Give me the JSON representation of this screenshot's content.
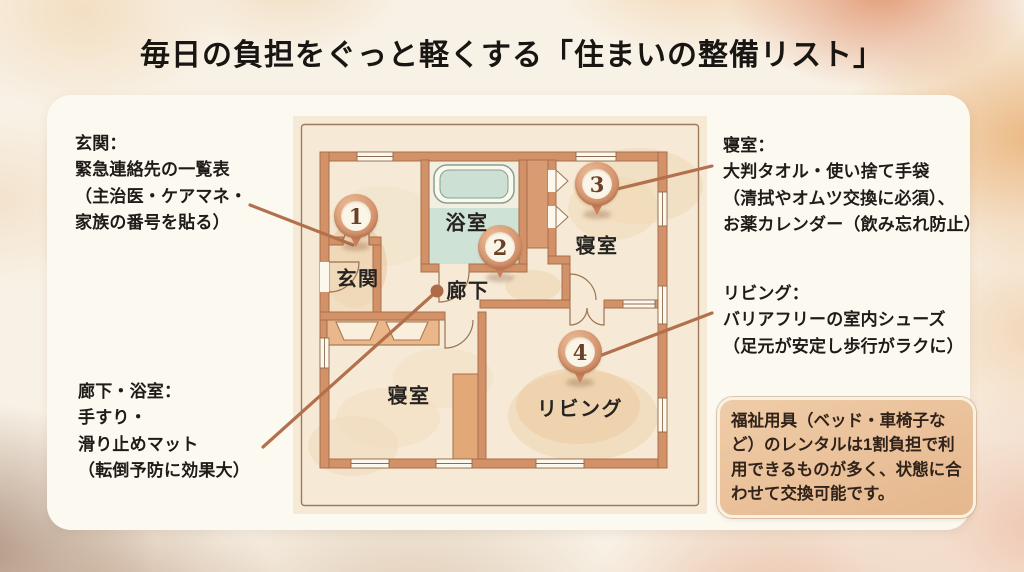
{
  "title": "毎日の負担をぐっと軽くする「住まいの整備リスト」",
  "notes": {
    "entrance": "玄関：\n緊急連絡先の一覧表\n（主治医・ケアマネ・\n家族の番号を貼る）",
    "bedroom": "寝室：\n大判タオル・使い捨て手袋\n（清拭やオムツ交換に必須）、\nお薬カレンダー（飲み忘れ防止）",
    "living": "リビング：\nバリアフリーの室内シューズ\n（足元が安定し歩行がラクに）",
    "hallway_bath": "廊下・浴室：\n手すり・\n滑り止めマット\n（転倒予防に効果大）"
  },
  "info_box": {
    "text": "福祉用具（ベッド・車椅子など）のレンタルは1割負担で利用できるものが多く、状態に合わせて交換可能です。"
  },
  "floor_plan": {
    "rooms": {
      "genkan": "玄関",
      "bath": "浴室",
      "hallway": "廊下",
      "bedroom_ne": "寝室",
      "bedroom_sw": "寝室",
      "living": "リビング"
    },
    "pins": [
      {
        "number": "1",
        "area": "genkan"
      },
      {
        "number": "2",
        "area": "hallway"
      },
      {
        "number": "3",
        "area": "bedroom_ne"
      },
      {
        "number": "4",
        "area": "living"
      }
    ]
  },
  "colors": {
    "wall": "#d39168",
    "connector_line": "#b2704c",
    "pin_ring": "#cd855d",
    "card_bg": "#fcf9f1",
    "info_box_bg": "#eac19c",
    "bathroom_floor": "#cfe2d6",
    "plan_paper": "#f6ead7"
  }
}
